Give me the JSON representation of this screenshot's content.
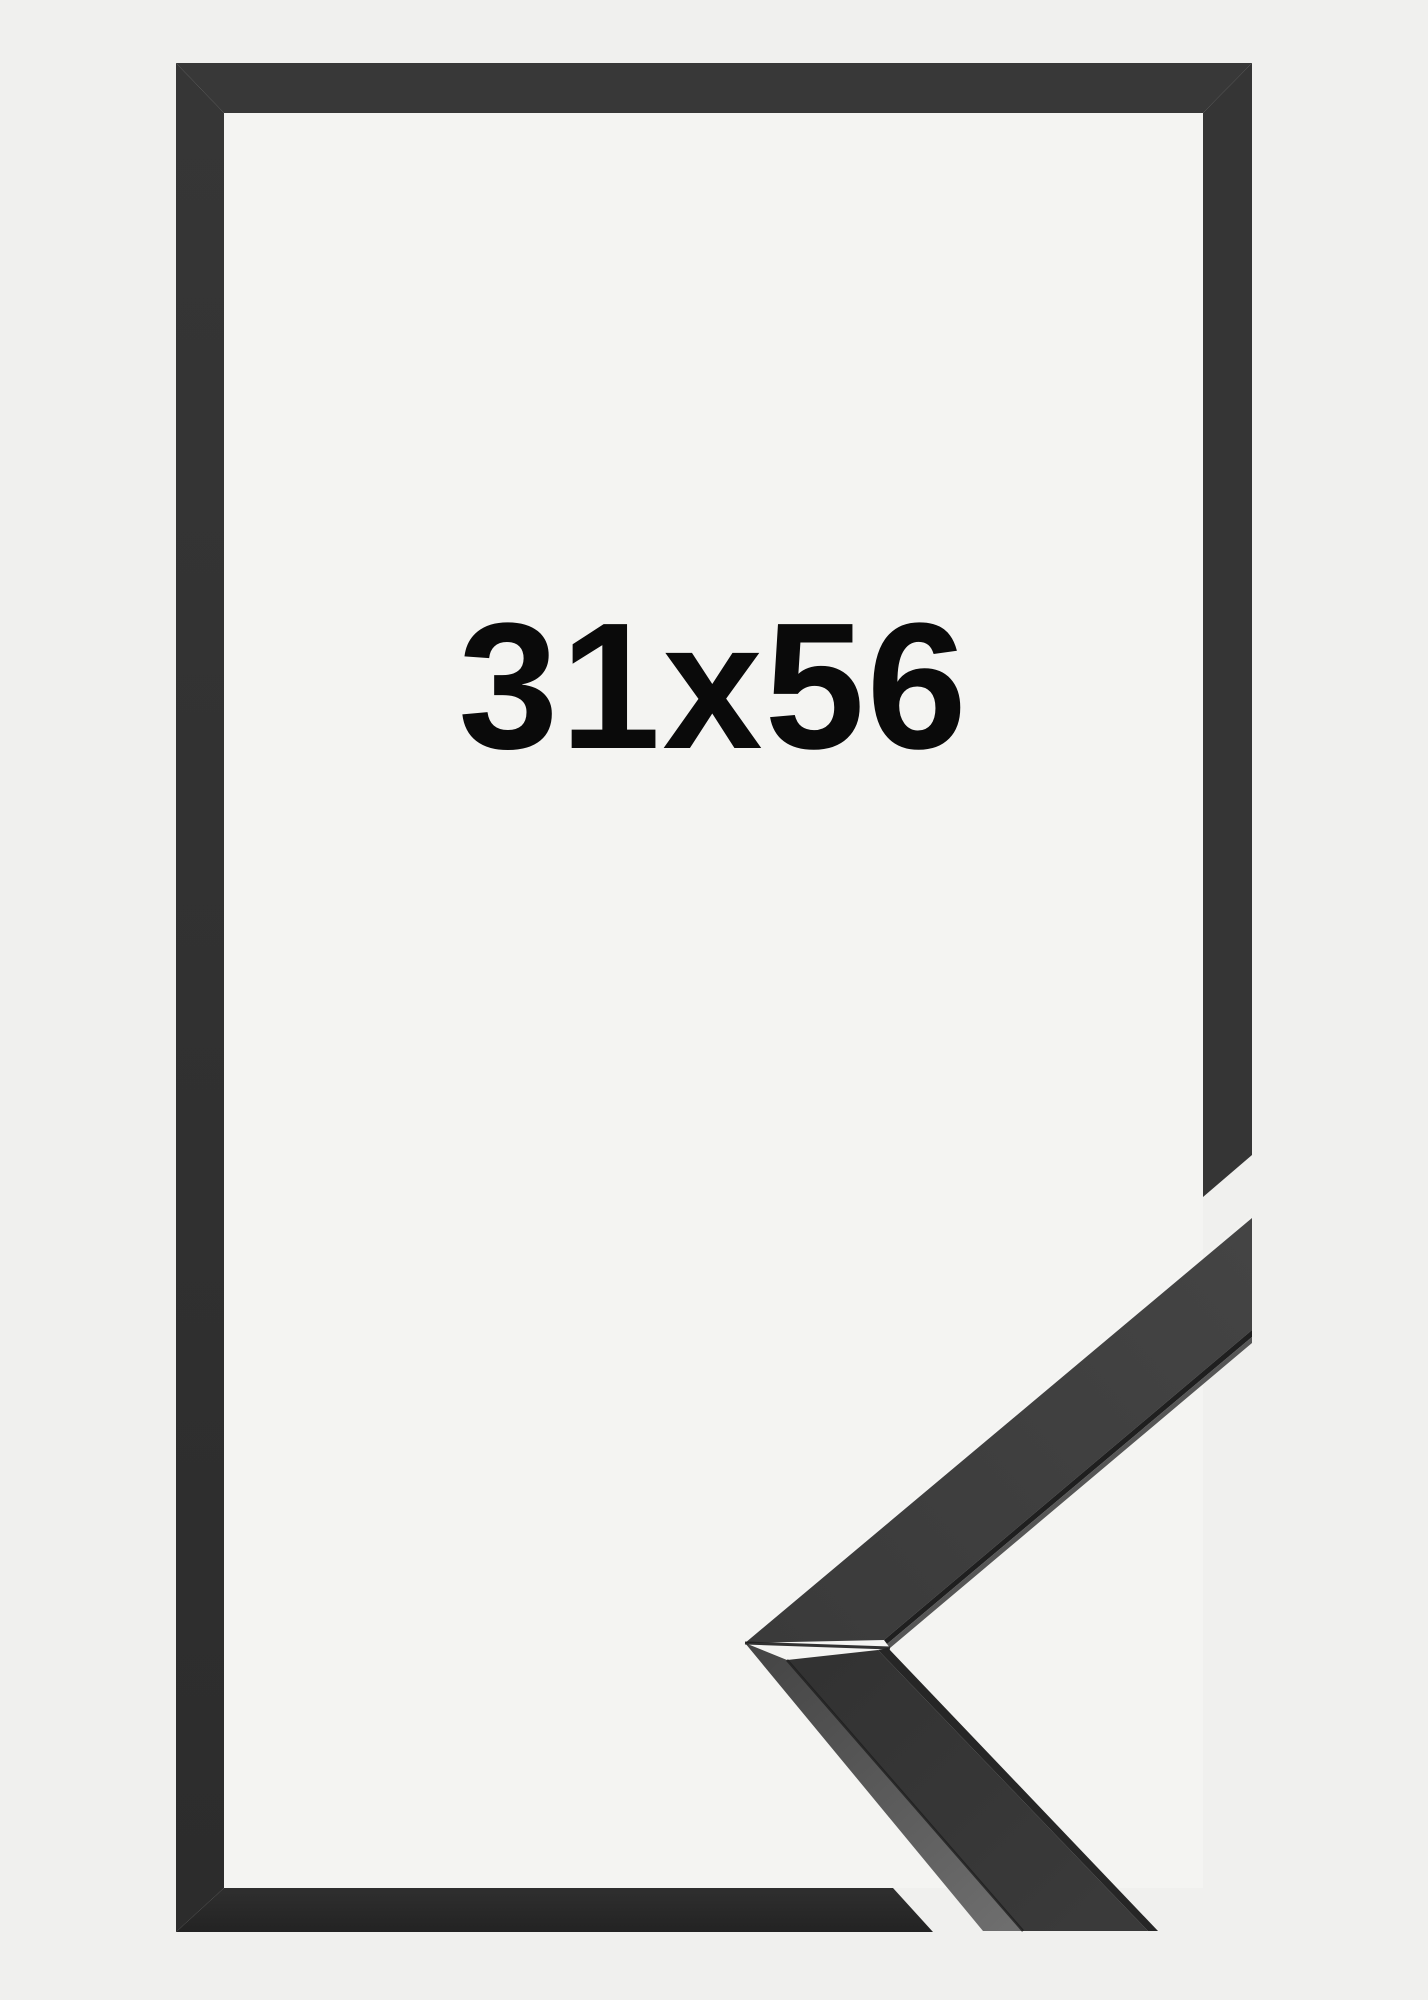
{
  "label": {
    "text": "31x56",
    "color": "#0a0a0a"
  },
  "colors": {
    "background_outer": "#f0f0ee",
    "background_inner": "#f4f4f2",
    "frame_top": "#383838",
    "frame_right": "#353535",
    "frame_left_top": "#363636",
    "frame_left_bottom": "#2c2c2c",
    "frame_bottom_top": "#2f2f2f",
    "frame_bottom_bottom": "#232323",
    "moulding_upper_start": "#3a3a3a",
    "moulding_upper_end": "#444444",
    "moulding_lower_start": "#323232",
    "moulding_lower_end": "#3a3a3a",
    "moulding_side_start": "#454545",
    "moulding_side_end": "#6e6e6e",
    "moulding_groove": "#1f1f1f",
    "moulding_lip": "#565656",
    "moulding_inner_edge": "#262626",
    "seam": "#1d1d1d",
    "edge_highlight": "rgba(255,255,255,0.15)"
  }
}
